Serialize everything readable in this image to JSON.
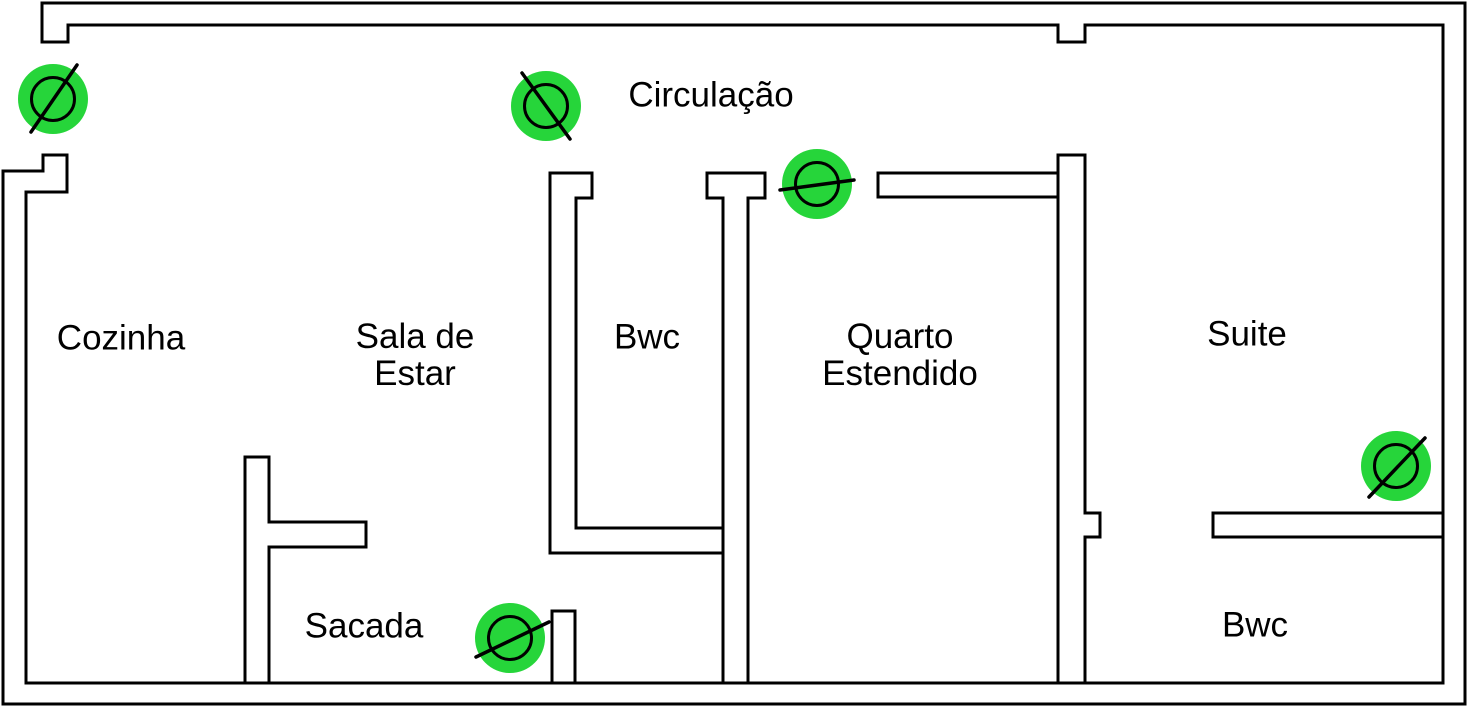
{
  "title": "Planta baixa - pontos de iluminação",
  "canvas": {
    "width": 1470,
    "height": 711
  },
  "colors": {
    "background": "#ffffff",
    "wall_stroke": "#000000",
    "lamp_fill": "#26d53a",
    "lamp_stroke": "#000000",
    "text": "#000000"
  },
  "style": {
    "wall_stroke_width": 3,
    "lamp_disc_radius": 35,
    "lamp_circle_radius": 21.5,
    "lamp_circle_stroke_width": 3,
    "lamp_slash_stroke_width": 3.5
  },
  "rooms": [
    {
      "id": "cozinha",
      "label": "Cozinha",
      "x": 121,
      "y": 338
    },
    {
      "id": "sala-de-estar",
      "label": "Sala de\nEstar",
      "x": 415,
      "y": 355
    },
    {
      "id": "bwc-social",
      "label": "Bwc",
      "x": 647,
      "y": 337
    },
    {
      "id": "circulacao",
      "label": "Circulação",
      "x": 711,
      "y": 95
    },
    {
      "id": "quarto-estendido",
      "label": "Quarto\nEstendido",
      "x": 900,
      "y": 355
    },
    {
      "id": "suite",
      "label": "Suite",
      "x": 1247,
      "y": 334
    },
    {
      "id": "sacada",
      "label": "Sacada",
      "x": 364,
      "y": 626
    },
    {
      "id": "bwc-suite",
      "label": "Bwc",
      "x": 1255,
      "y": 625
    }
  ],
  "lamps": [
    {
      "id": "lamp-entrance",
      "cx": 53,
      "cy": 99,
      "slash": [
        31,
        132,
        77,
        65
      ]
    },
    {
      "id": "lamp-circulacao",
      "cx": 546,
      "cy": 106,
      "slash": [
        522,
        73,
        570,
        139
      ]
    },
    {
      "id": "lamp-quarto",
      "cx": 817,
      "cy": 184,
      "slash": [
        780,
        190,
        854,
        180
      ]
    },
    {
      "id": "lamp-suite",
      "cx": 1396,
      "cy": 466,
      "slash": [
        1369,
        497,
        1425,
        438
      ]
    },
    {
      "id": "lamp-sacada",
      "cx": 510,
      "cy": 638,
      "slash": [
        476,
        657,
        549,
        622
      ]
    }
  ],
  "walls": [
    {
      "id": "outer-shell",
      "d": "M42,3 H1465 V704 H3 V171 H43 V155 H67 V192 H26 V683 H1443 V25 H1085 V42 H1058 V25 H68 V42 H42 Z"
    },
    {
      "id": "bwc-left-wall",
      "d": "M550,173 H592 V198 H576 V528 H723 M550,173 V553 H723"
    },
    {
      "id": "bwc-quarto-wall",
      "d": "M707,173 H765 V198 H748 V683 M707,173 V198 H723 V683"
    },
    {
      "id": "quarto-top-wall",
      "d": "M1058,173 H878 V197 H1058"
    },
    {
      "id": "quarto-suite-wall",
      "d": "M1058,683 V155 H1085 V513 H1100 V537 H1085 V683"
    },
    {
      "id": "suite-bwc-wall",
      "d": "M1443,513 H1213 V537 H1443"
    },
    {
      "id": "sacada-left-wall",
      "d": "M245,683 V457 H269 V522 H366 V547 H269 V683"
    },
    {
      "id": "sacada-right-stub",
      "d": "M552,683 V611 H575 V683"
    }
  ]
}
